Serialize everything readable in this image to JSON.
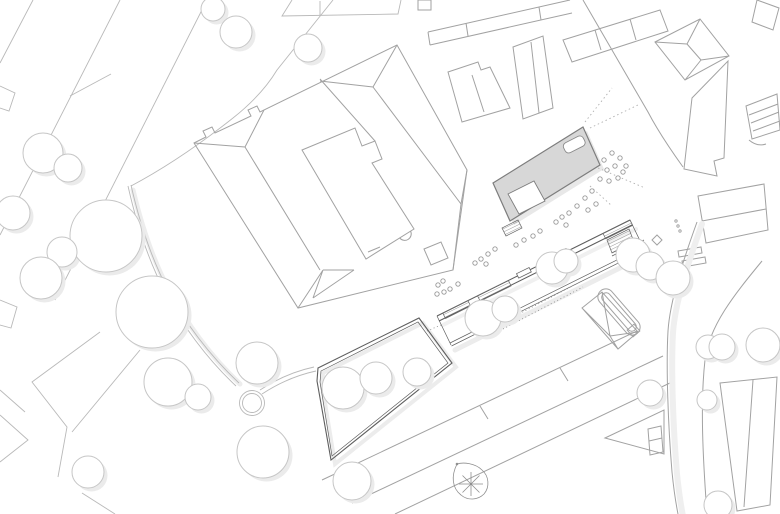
{
  "meta": {
    "title": "Architectural site plan drawing",
    "description": "Top-down black and white urban site plan with one new building volume highlighted in gray"
  },
  "canvas": {
    "width": 780,
    "height": 514
  },
  "palette": {
    "background": "#ffffff",
    "context_line": "#a2a2a2",
    "street_line": "#b9b9b9",
    "tree_line": "#c6c6c6",
    "shadow_color": "#ebebeb",
    "design_line": "#5e5e5e",
    "highlight_fill": "#d7d7d7",
    "highlight_stroke": "#7d7d7d",
    "dot_stroke": "#999999",
    "hatch_line": "#6e6e6e"
  },
  "elements": {
    "highlighted_building": "new building volume, gray fill with white rooftop opening",
    "courtyard_building": "large existing perimeter block with hipped roof lines and inner courtyard",
    "linear_building": "long narrow new structure with hatched stairs and ramps",
    "garden_enclosure": "trapezoidal walled garden with trees",
    "curved_path_west": "curved footpath ending in a circular turning loop",
    "curved_road_east": "wide curved road sweeping along the east side",
    "north_arrow": "teardrop shaped tree/marker symbol with radial spokes"
  },
  "trees": [
    [
      213,
      9,
      12
    ],
    [
      236,
      32,
      16
    ],
    [
      308,
      48,
      14
    ],
    [
      43,
      153,
      20
    ],
    [
      68,
      168,
      14
    ],
    [
      13,
      213,
      17
    ],
    [
      106,
      236,
      36
    ],
    [
      62,
      252,
      15
    ],
    [
      41,
      278,
      21
    ],
    [
      152,
      312,
      36
    ],
    [
      168,
      382,
      24
    ],
    [
      198,
      397,
      13
    ],
    [
      88,
      472,
      16
    ],
    [
      257,
      363,
      21
    ],
    [
      263,
      452,
      26
    ],
    [
      343,
      388,
      21
    ],
    [
      376,
      378,
      16
    ],
    [
      417,
      372,
      14
    ],
    [
      352,
      481,
      19
    ],
    [
      483,
      318,
      18
    ],
    [
      505,
      309,
      13
    ],
    [
      552,
      268,
      16
    ],
    [
      566,
      261,
      12
    ],
    [
      633,
      255,
      17
    ],
    [
      650,
      266,
      14
    ],
    [
      673,
      278,
      17
    ],
    [
      650,
      393,
      13
    ],
    [
      708,
      347,
      12
    ],
    [
      707,
      400,
      10
    ],
    [
      722,
      347,
      13
    ],
    [
      763,
      345,
      17
    ],
    [
      718,
      505,
      14
    ]
  ],
  "planting_dots": [
    [
      604,
      160
    ],
    [
      612,
      153
    ],
    [
      620,
      158
    ],
    [
      607,
      170
    ],
    [
      615,
      166
    ],
    [
      623,
      172
    ],
    [
      600,
      179
    ],
    [
      609,
      181
    ],
    [
      618,
      178
    ],
    [
      626,
      166
    ],
    [
      592,
      191
    ],
    [
      585,
      198
    ],
    [
      596,
      204
    ],
    [
      588,
      210
    ],
    [
      577,
      206
    ],
    [
      569,
      213
    ],
    [
      562,
      217
    ],
    [
      556,
      222
    ],
    [
      566,
      225
    ],
    [
      540,
      231
    ],
    [
      533,
      236
    ],
    [
      524,
      240
    ],
    [
      516,
      245
    ],
    [
      495,
      249
    ],
    [
      488,
      254
    ],
    [
      481,
      259
    ],
    [
      475,
      263
    ],
    [
      486,
      264
    ],
    [
      458,
      284
    ],
    [
      450,
      289
    ],
    [
      443,
      281
    ],
    [
      438,
      285
    ],
    [
      444,
      292
    ],
    [
      437,
      294
    ]
  ],
  "tiny_marks": [
    [
      676,
      221
    ],
    [
      678,
      226
    ],
    [
      680,
      231
    ]
  ],
  "dashed_rays": [
    [
      585,
      122,
      612,
      88
    ],
    [
      590,
      128,
      640,
      104
    ],
    [
      598,
      168,
      645,
      188
    ],
    [
      590,
      186,
      612,
      206
    ]
  ]
}
